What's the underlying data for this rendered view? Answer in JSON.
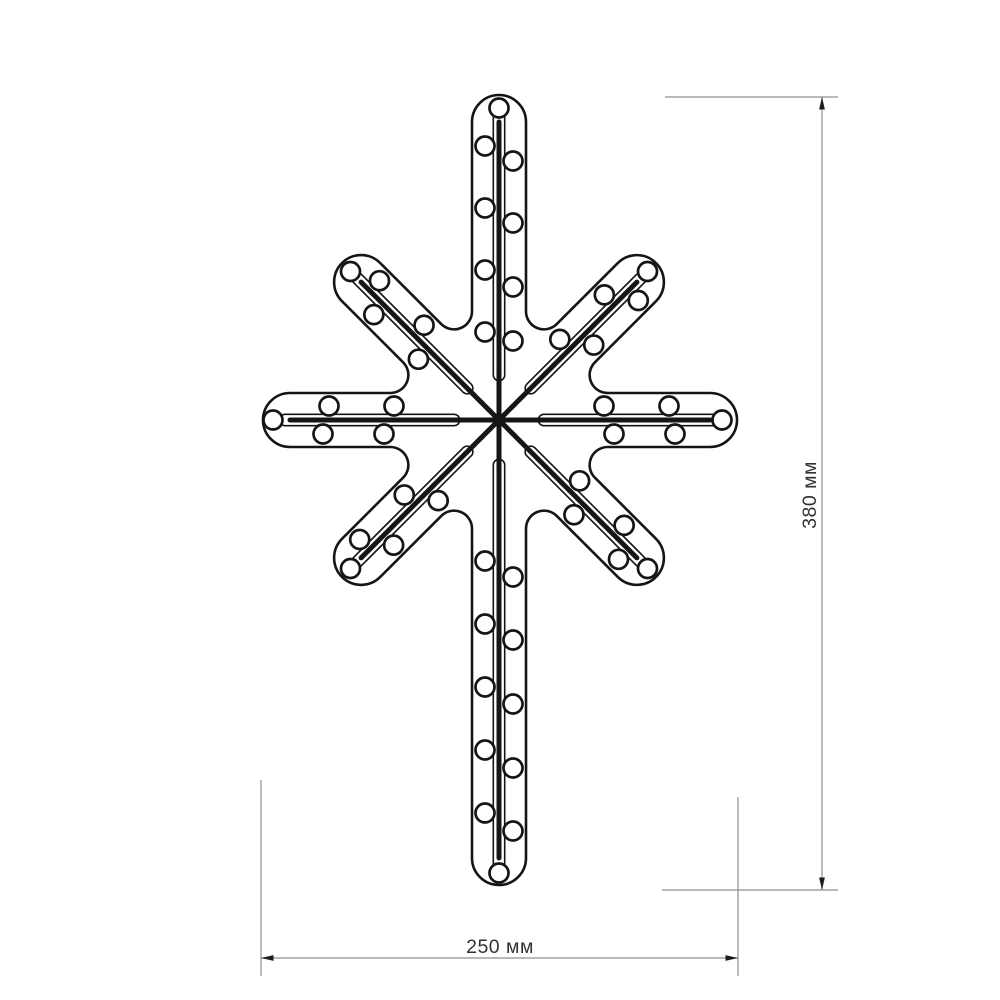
{
  "diagram": {
    "title": "LED star motif technical drawing",
    "background_color": "#ffffff",
    "outline_color": "#151515",
    "dimension_line_color": "#8f8f8f",
    "dimension_arrow_color": "#1c1c1c",
    "dimension_text_color": "#323232",
    "dimensions": [
      {
        "id": "height",
        "label": "380 мм",
        "value_mm": 380,
        "orientation": "vertical"
      },
      {
        "id": "width",
        "label": "250 мм",
        "value_mm": 250,
        "orientation": "horizontal"
      }
    ],
    "star": {
      "center_x": 499,
      "center_y": 420,
      "ray_half_width": 27,
      "fillet_radius": 18,
      "led_radius": 9.5,
      "led_stroke": 2.7,
      "outline_stroke": 2.6,
      "led_count": 50,
      "strip": {
        "core_width": 5,
        "tube_width": 13,
        "tube_stroke_gap": 9.8,
        "tube_start": 45,
        "tube_overhang": 5
      },
      "rays": [
        {
          "name": "right",
          "angle": 0,
          "cap_dist": 211,
          "leds_a": [
            105,
            170
          ],
          "leds_b": [
            115,
            176
          ],
          "tip_led": 223
        },
        {
          "name": "se",
          "angle": 45,
          "cap_dist": 195,
          "leds_a": [
            100,
            163
          ],
          "leds_b": [
            120,
            183
          ],
          "tip_led": 210
        },
        {
          "name": "down",
          "angle": 90,
          "cap_dist": 438,
          "leds_a": [
            157,
            220,
            284,
            348,
            411
          ],
          "leds_b": [
            141,
            204,
            267,
            330,
            393
          ],
          "tip_led": 453
        },
        {
          "name": "sw",
          "angle": 135,
          "cap_dist": 195,
          "leds_a": [
            100,
            163
          ],
          "leds_b": [
            120,
            183
          ],
          "tip_led": 210
        },
        {
          "name": "left",
          "angle": 180,
          "cap_dist": 209,
          "leds_a": [
            115,
            176
          ],
          "leds_b": [
            105,
            170
          ],
          "tip_led": 226
        },
        {
          "name": "nw",
          "angle": 225,
          "cap_dist": 195,
          "leds_a": [
            100,
            163
          ],
          "leds_b": [
            120,
            183
          ],
          "tip_led": 210
        },
        {
          "name": "up",
          "angle": 270,
          "cap_dist": 298,
          "leds_a": [
            88,
            150,
            212,
            274
          ],
          "leds_b": [
            79,
            133,
            197,
            259
          ],
          "tip_led": 312
        },
        {
          "name": "ne",
          "angle": 315,
          "cap_dist": 195,
          "leds_a": [
            100,
            163
          ],
          "leds_b": [
            120,
            183
          ],
          "tip_led": 210
        }
      ]
    },
    "dim_v": {
      "x": 822,
      "y1": 97,
      "y2": 890,
      "ext_top": {
        "y": 97,
        "x1": 665,
        "x2": 838
      },
      "ext_bottom": {
        "y": 890,
        "x1": 662,
        "x2": 838
      },
      "label_x": 816,
      "label_y": 495
    },
    "dim_h": {
      "y": 958,
      "x1": 261,
      "x2": 738,
      "ext_left": {
        "x": 261,
        "y1": 780,
        "y2": 976
      },
      "ext_right": {
        "x": 738,
        "y1": 797,
        "y2": 976
      },
      "label_x": 500,
      "label_y": 953
    }
  }
}
